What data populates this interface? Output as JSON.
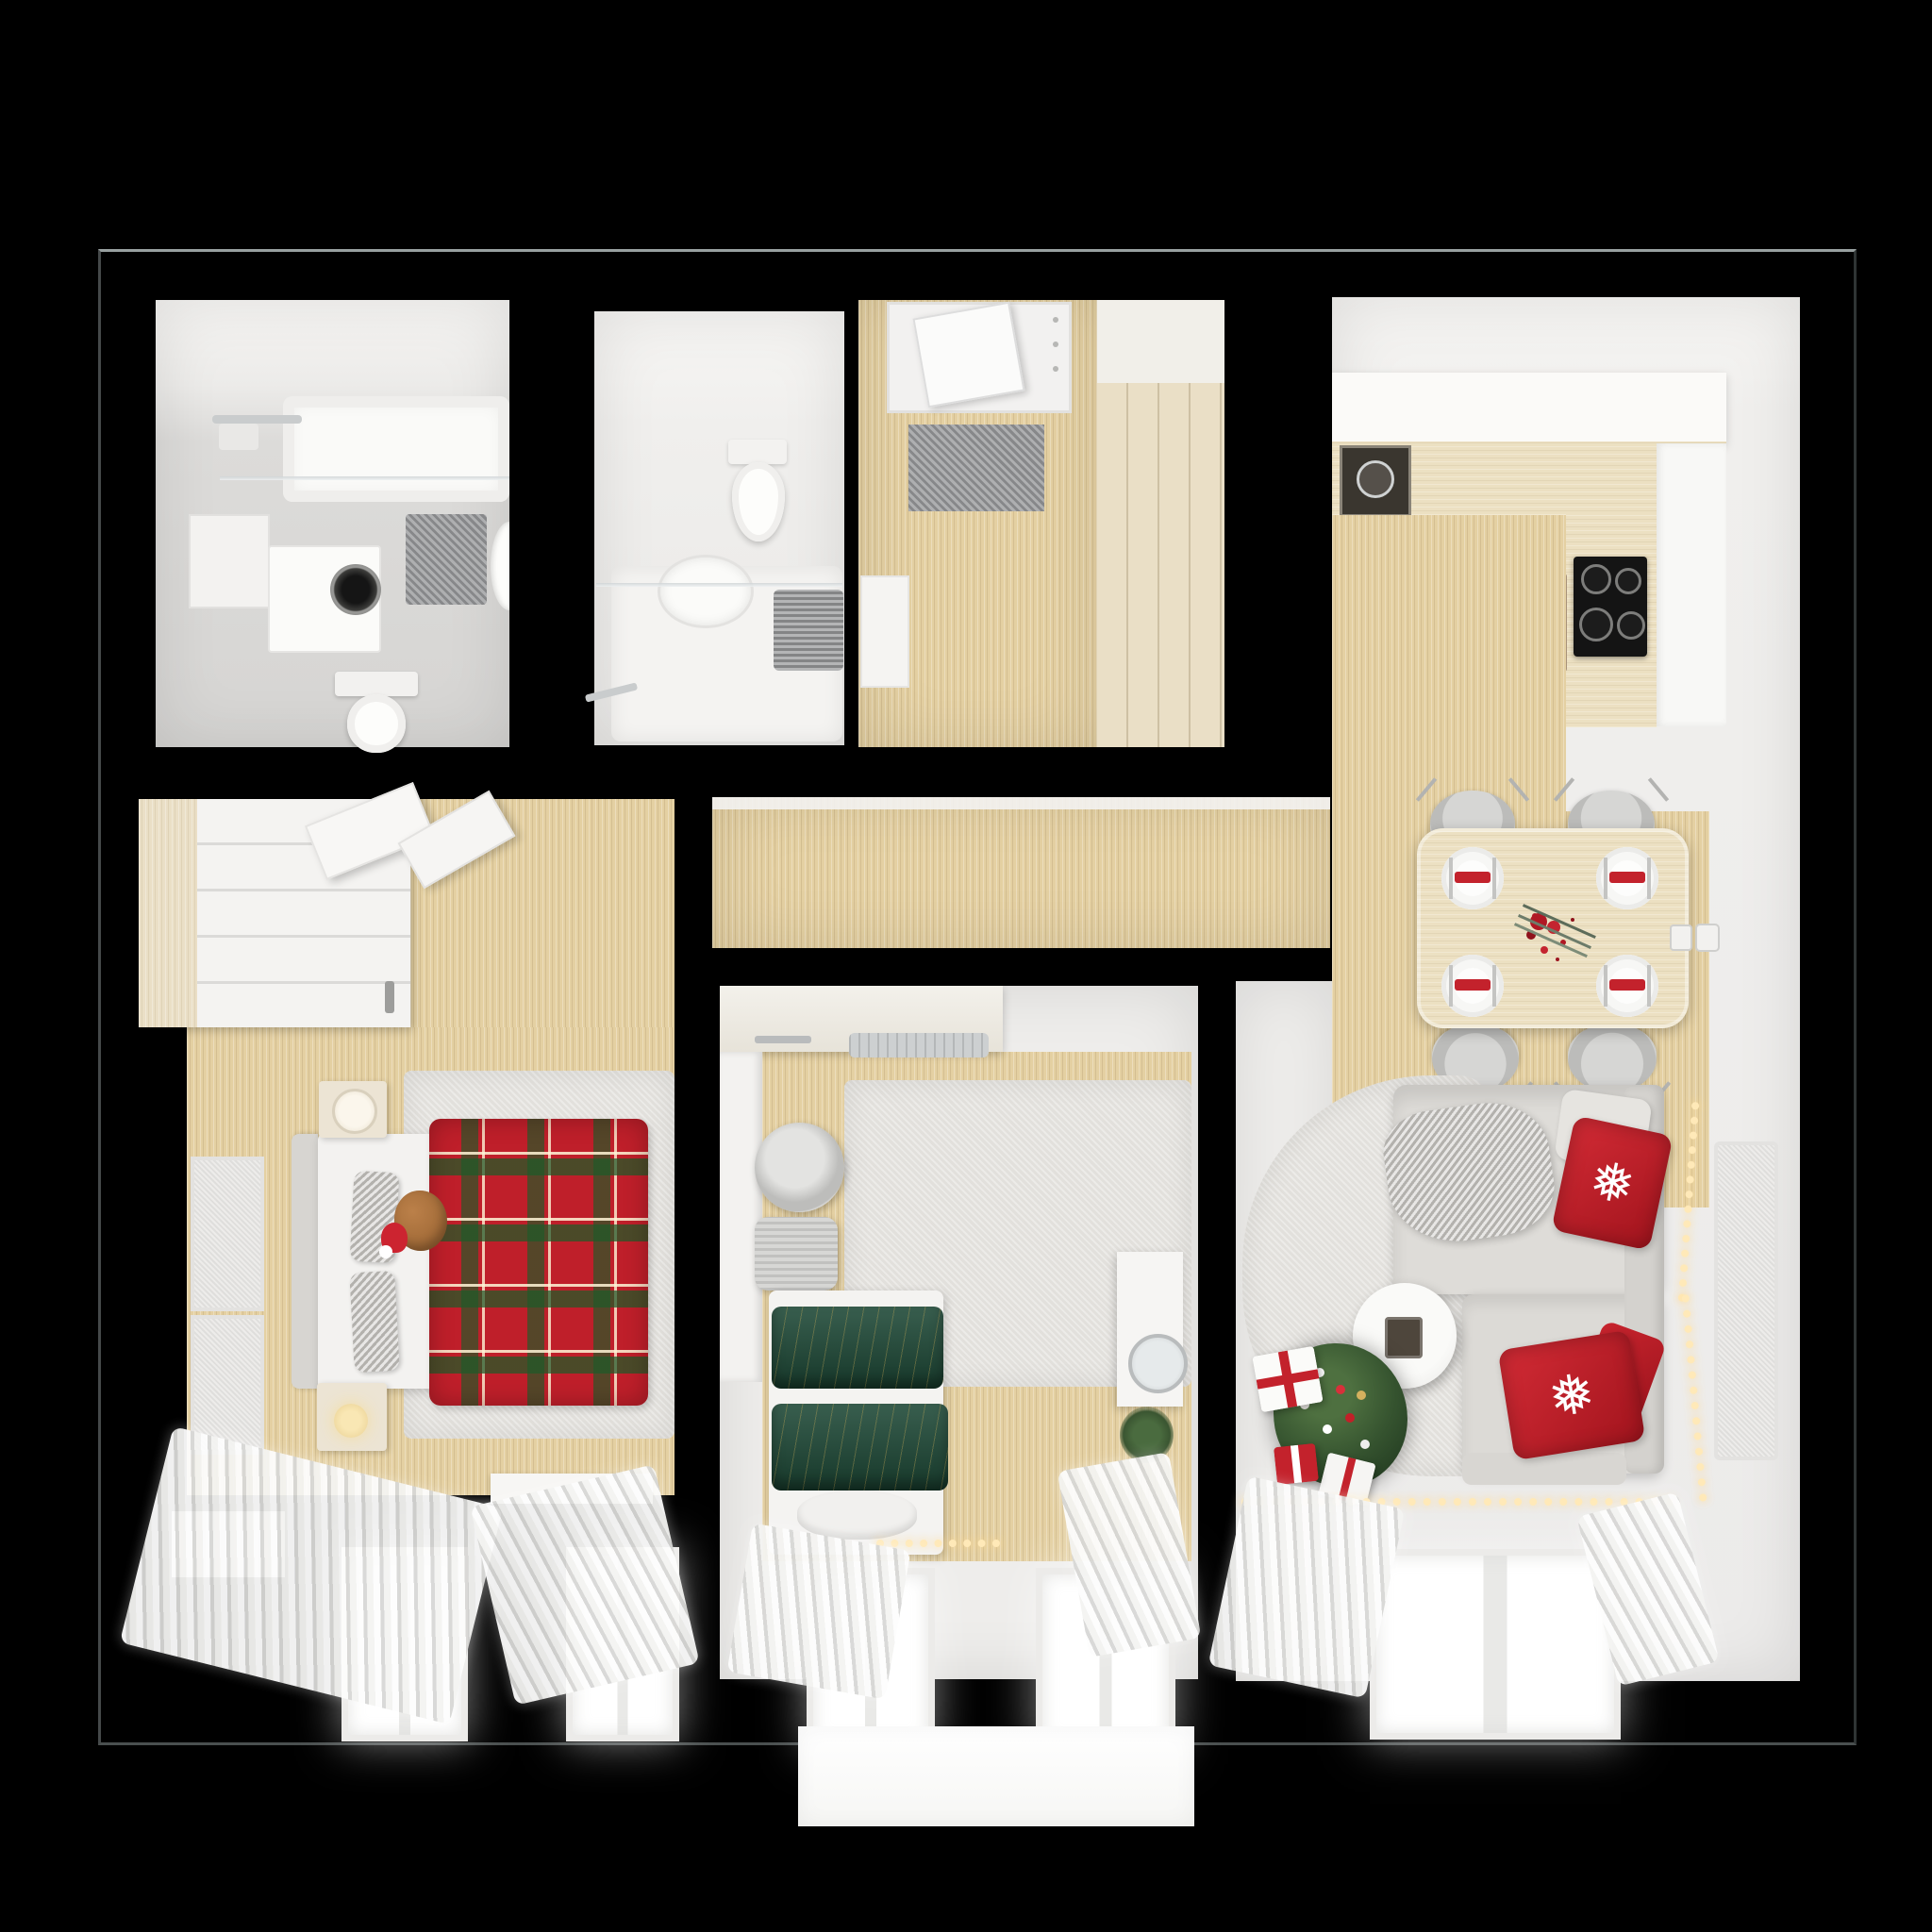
{
  "meta": {
    "title": "Top-down 3D render of a two-bedroom apartment floor plan decorated for Christmas",
    "view": "top-down axonometric",
    "theme": "christmas-decor",
    "background": "#000000"
  },
  "palette": {
    "background": "#000000",
    "wall_white": "#f1f0ee",
    "wood_floor": "#e4d0a2",
    "closet_wood": "#eadfc6",
    "tile_gray": "#d8d7d5",
    "rug_gray": "#e2e0dc",
    "accent_red": "#c3222c",
    "tartan_red": "#bf1f2a",
    "velvet_green": "#1d4836",
    "tree_green": "#2f4e2e",
    "sofa_gray": "#dcdad6",
    "light_warm": "#ffe9b8",
    "counter_wood": "#ece0c2",
    "cooktop_black": "#141414"
  },
  "icons": {
    "snowflake": "❅"
  },
  "rooms": [
    {
      "id": "bathroom",
      "label": "Bathroom",
      "furniture": [
        "bathtub",
        "shower glass screen",
        "towel rail",
        "wall cabinet",
        "washing machine",
        "bath mat",
        "toilet",
        "washbasin"
      ]
    },
    {
      "id": "wc",
      "label": "Guest WC",
      "furniture": [
        "toilet",
        "shower tub",
        "glass screen",
        "grey towel",
        "robe hooks"
      ]
    },
    {
      "id": "hallway",
      "label": "Entrance hall",
      "furniture": [
        "entrance door",
        "grey doormat",
        "built-in wardrobe",
        "console shelf"
      ]
    },
    {
      "id": "corridor",
      "label": "Corridor",
      "furniture": []
    },
    {
      "id": "master-bedroom",
      "label": "Master bedroom",
      "furniture": [
        "wardrobe with open doors",
        "double bed",
        "red tartan plaid",
        "teddy bear with santa hat",
        "grey pillows",
        "nightstand with lamp",
        "nightstand with candle",
        "two wall art panels",
        "rug",
        "radiator",
        "two windows with sheer curtains"
      ]
    },
    {
      "id": "kids-bedroom",
      "label": "Second bedroom",
      "furniture": [
        "desk unit",
        "air conditioner",
        "wardrobe column",
        "round pouf",
        "laundry basket",
        "single bed",
        "green velvet duvet",
        "white pillow",
        "dresser with round mirror",
        "potted plant",
        "fairy lights",
        "rug",
        "two windows with sheer curtains"
      ]
    },
    {
      "id": "living-kitchen",
      "label": "Living room with kitchen",
      "furniture": [
        "L-shaped kitchen counter",
        "inset sink",
        "induction cooktop",
        "oven column",
        "dining table for four",
        "four grey chairs",
        "four place settings with red napkin rings",
        "red berry centerpiece",
        "double wall outlet",
        "corner sofa",
        "red snowflake cushions",
        "grey knit throw",
        "round coffee table",
        "christmas tree with ornaments",
        "gift boxes",
        "string lights on wall",
        "garland along window",
        "area rug",
        "window with sheer curtains",
        "wall panel"
      ]
    },
    {
      "id": "balcony",
      "label": "Balcony slab",
      "furniture": []
    }
  ]
}
